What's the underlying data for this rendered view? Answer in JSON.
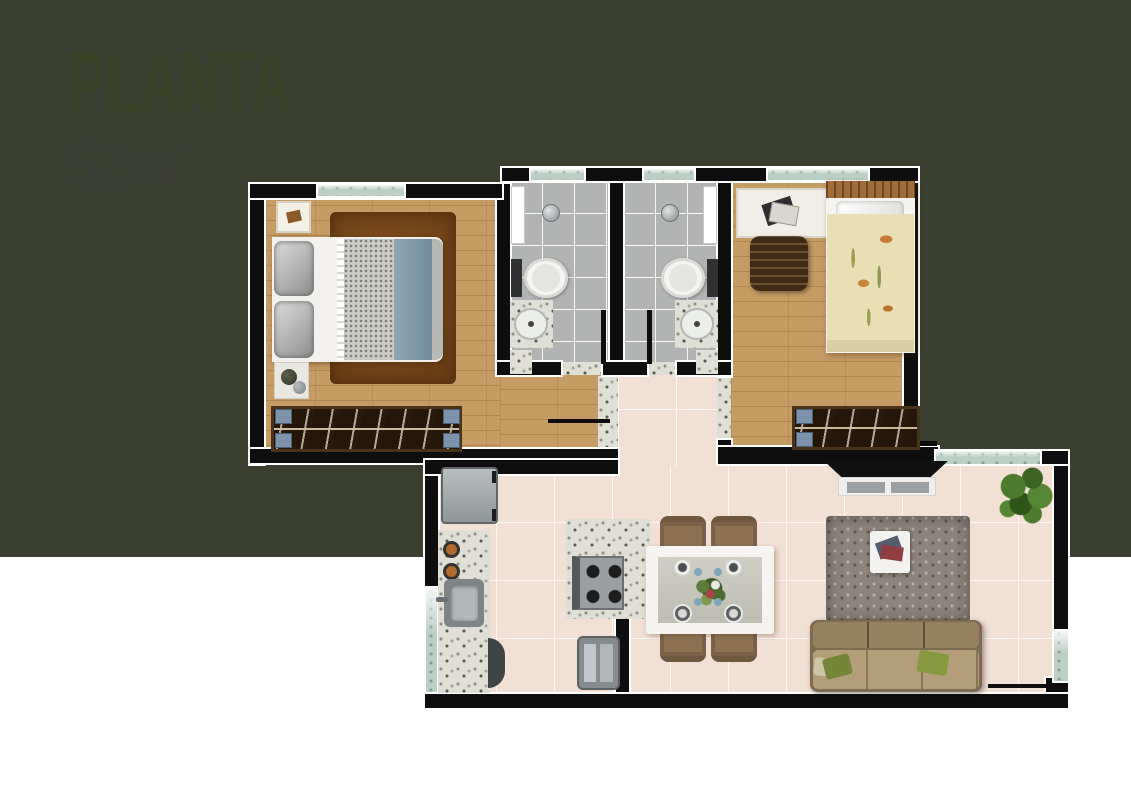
{
  "header": {
    "title": "PLANTA",
    "area_value": "52m",
    "area_superscript": "2"
  },
  "colors": {
    "background_top": "#ffffff",
    "stripe": "#9d8659",
    "background_bottom": "#3a3f2f",
    "title": "#3a4126",
    "area_text": "#3c3f36",
    "wall": "#0e0e0e",
    "wall_outline": "#ffffff",
    "wood": "#c59c64",
    "tile_gray": "#b2b4b3",
    "tile_pink": "#f3e0d5",
    "granite": "#e0dfd6",
    "window": "#bccfc5",
    "rug_brown": "#7a4a1e",
    "rug_gray": "#8d847b",
    "sofa": "#a98f6c",
    "blanket_blue": "#7d98aa",
    "bed_floral": "#e9dfb4",
    "wardrobe_wood": "#241709",
    "dining_chair": "#8e7254",
    "plant_green": "#4c7a2e"
  },
  "plan": {
    "rooms": [
      "bedroom-1",
      "bathroom-1",
      "bathroom-2",
      "bedroom-2",
      "hallway",
      "kitchen",
      "dining-area",
      "living-room"
    ],
    "fixtures": [
      "double-bed",
      "brown-rug",
      "wardrobe",
      "wall-picture",
      "side-table",
      "shower",
      "toilet",
      "washbasin",
      "desk",
      "office-chair",
      "single-bed",
      "fridge",
      "counter-sink",
      "cooktop-island",
      "oven",
      "trash-bin",
      "dining-table",
      "dining-chairs",
      "tv",
      "tv-console",
      "gray-rug",
      "coffee-table",
      "sofa",
      "potted-plant"
    ]
  }
}
